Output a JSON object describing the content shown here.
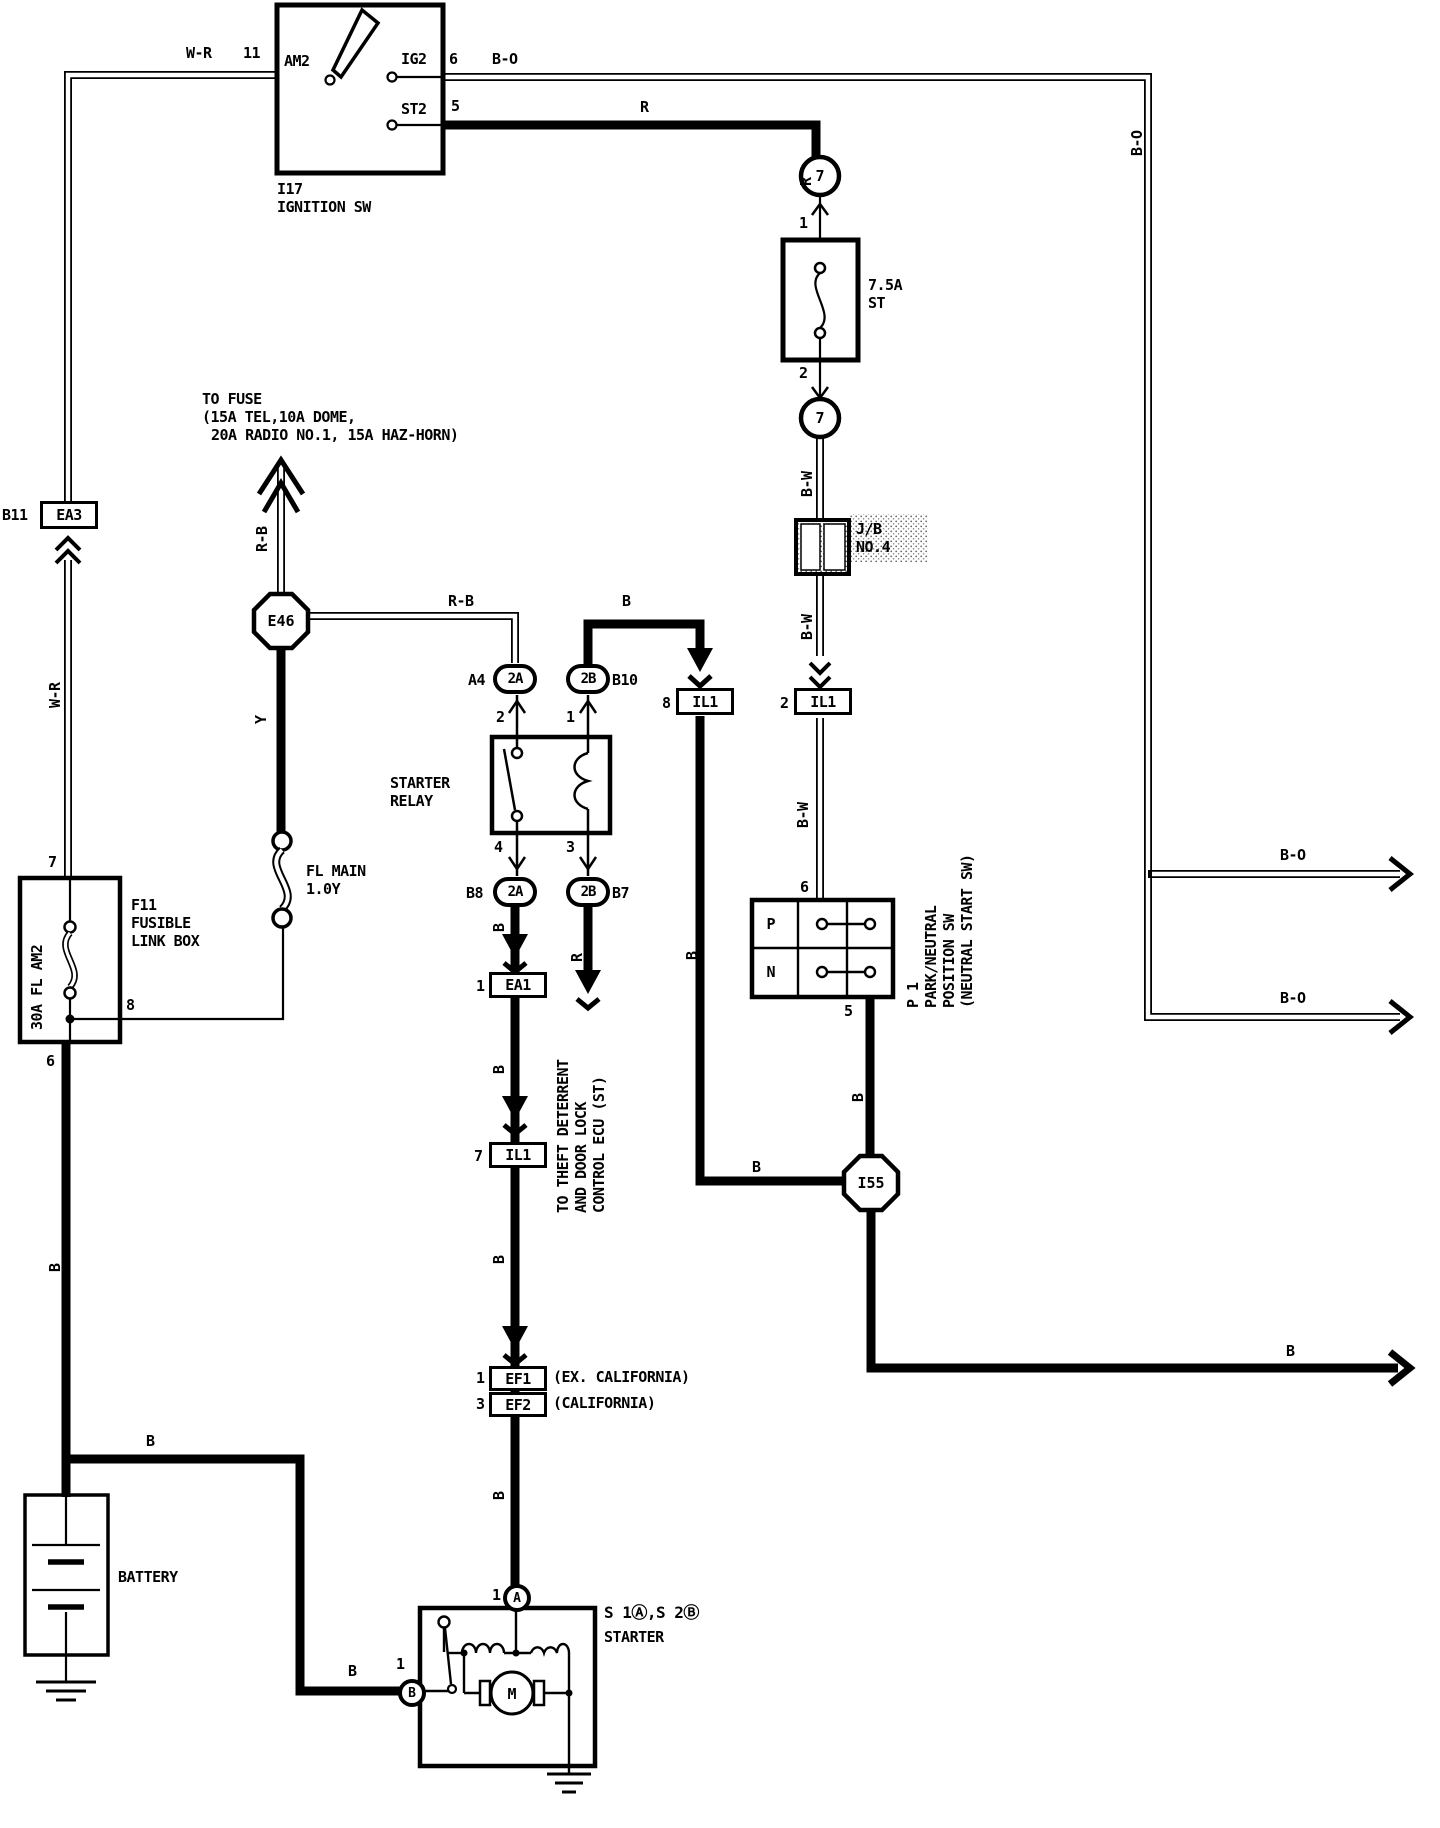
{
  "wires": {
    "w_r": "W-R",
    "b_o": "B-O",
    "r": "R",
    "r_b": "R-B",
    "b": "B",
    "b_w": "B-W",
    "y": "Y"
  },
  "pins": {
    "p11": "11",
    "p6": "6",
    "p5": "5",
    "p1": "1",
    "p2": "2",
    "p3": "3",
    "p4": "4",
    "p7": "7",
    "p8": "8"
  },
  "ignition": {
    "code": "I17",
    "name": "IGNITION SW",
    "am2": "AM2",
    "ig2": "IG2",
    "st2": "ST2"
  },
  "fuse": {
    "amp": "7.5A",
    "name": "ST"
  },
  "c7": "7",
  "jb": {
    "l1": "J/B",
    "l2": "NO.4"
  },
  "to_fuse": {
    "l1": "TO FUSE",
    "l2": "(15A TEL,10A DOME,",
    "l3": "20A RADIO NO.1, 15A HAZ-HORN)"
  },
  "ea3": {
    "pin": "B11",
    "code": "EA3"
  },
  "e46": "E46",
  "i55": "I55",
  "fl_main": {
    "l1": "FL MAIN",
    "l2": "1.0Y"
  },
  "f11": {
    "code": "F11",
    "l2": "FUSIBLE",
    "l3": "LINK BOX",
    "link": "30A FL AM2"
  },
  "battery": "BATTERY",
  "relay": {
    "l1": "STARTER",
    "l2": "RELAY"
  },
  "ovals": {
    "a4": "A4",
    "b10": "B10",
    "b8": "B8",
    "b7": "B7",
    "c2a": "2A",
    "c2b": "2B"
  },
  "il1": "IL1",
  "ea1": "EA1",
  "ef1": {
    "code": "EF1",
    "note": "(EX. CALIFORNIA)"
  },
  "ef2": {
    "code": "EF2",
    "note": "(CALIFORNIA)"
  },
  "ecu": {
    "l1": "TO THEFT DETERRENT",
    "l2": "AND DOOR LOCK",
    "l3": "CONTROL ECU (ST)"
  },
  "pn": {
    "p": "P",
    "n": "N",
    "l1": "P 1",
    "l2": "PARK/NEUTRAL",
    "l3": "POSITION SW",
    "l4": "(NEUTRAL START SW)"
  },
  "starter": {
    "s": "S 1Ⓐ,S 2Ⓑ",
    "name": "STARTER",
    "a": "A",
    "b": "B",
    "m": "M"
  }
}
